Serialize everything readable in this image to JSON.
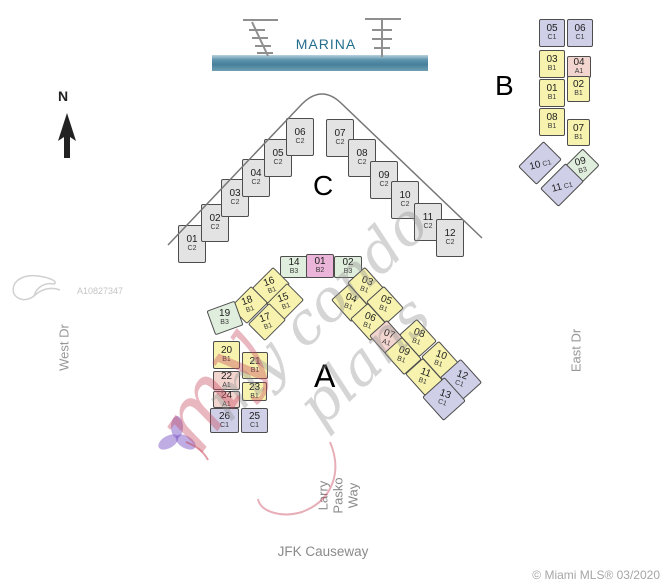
{
  "labels": {
    "marina": "MARINA",
    "north": "N"
  },
  "streets": {
    "west": "West Dr",
    "east": "East Dr",
    "south": "JFK Causeway",
    "inner_lines": [
      "Larry",
      "Pasko",
      "Way"
    ]
  },
  "watermarks": {
    "photo_id": "A10827347",
    "script": "my condo plans",
    "script_red": "my",
    "attribution": "© Miami MLS® 03/2020"
  },
  "unit_colors": {
    "A1": "#f3d5cf",
    "B1": "#f7f3ae",
    "B2": "#eab5d8",
    "B3": "#e0eedd",
    "C1": "#cfcfe8",
    "C2": "#e3e3e3"
  },
  "buildings": [
    {
      "id": "C",
      "label": "C",
      "label_pos": {
        "x": 313,
        "y": 172,
        "size": 28
      },
      "units": [
        {
          "n": "01",
          "t": "C2",
          "x": 178,
          "y": 225,
          "w": 28,
          "h": 38,
          "r": 0,
          "lr": 0
        },
        {
          "n": "02",
          "t": "C2",
          "x": 201,
          "y": 204,
          "w": 28,
          "h": 38,
          "r": 0,
          "lr": 0
        },
        {
          "n": "03",
          "t": "C2",
          "x": 221,
          "y": 179,
          "w": 28,
          "h": 38,
          "r": 0,
          "lr": 0
        },
        {
          "n": "04",
          "t": "C2",
          "x": 242,
          "y": 159,
          "w": 28,
          "h": 38,
          "r": 0,
          "lr": 0
        },
        {
          "n": "05",
          "t": "C2",
          "x": 264,
          "y": 139,
          "w": 28,
          "h": 38,
          "r": 0,
          "lr": 0
        },
        {
          "n": "06",
          "t": "C2",
          "x": 286,
          "y": 118,
          "w": 28,
          "h": 38,
          "r": 0,
          "lr": 0
        },
        {
          "n": "07",
          "t": "C2",
          "x": 326,
          "y": 119,
          "w": 28,
          "h": 38,
          "r": 0,
          "lr": 0
        },
        {
          "n": "08",
          "t": "C2",
          "x": 348,
          "y": 139,
          "w": 28,
          "h": 38,
          "r": 0,
          "lr": 0
        },
        {
          "n": "09",
          "t": "C2",
          "x": 370,
          "y": 161,
          "w": 28,
          "h": 38,
          "r": 0,
          "lr": 0
        },
        {
          "n": "10",
          "t": "C2",
          "x": 391,
          "y": 181,
          "w": 28,
          "h": 38,
          "r": 0,
          "lr": 0
        },
        {
          "n": "11",
          "t": "C2",
          "x": 414,
          "y": 203,
          "w": 28,
          "h": 38,
          "r": 0,
          "lr": 0
        },
        {
          "n": "12",
          "t": "C2",
          "x": 436,
          "y": 219,
          "w": 28,
          "h": 38,
          "r": 0,
          "lr": 0
        }
      ]
    },
    {
      "id": "B",
      "label": "B",
      "label_pos": {
        "x": 495,
        "y": 72,
        "size": 28
      },
      "units": [
        {
          "n": "05",
          "t": "C1",
          "x": 539,
          "y": 19,
          "w": 26,
          "h": 28,
          "r": 0,
          "lr": 0
        },
        {
          "n": "06",
          "t": "C1",
          "x": 567,
          "y": 19,
          "w": 26,
          "h": 28,
          "r": 0,
          "lr": 0
        },
        {
          "n": "03",
          "t": "B1",
          "x": 539,
          "y": 50,
          "w": 26,
          "h": 28,
          "r": 0,
          "lr": 0
        },
        {
          "n": "04",
          "t": "A1",
          "x": 567,
          "y": 56,
          "w": 24,
          "h": 22,
          "r": 0,
          "lr": 0
        },
        {
          "n": "01",
          "t": "B1",
          "x": 539,
          "y": 79,
          "w": 26,
          "h": 28,
          "r": 0,
          "lr": 0
        },
        {
          "n": "02",
          "t": "B1",
          "x": 567,
          "y": 76,
          "w": 23,
          "h": 26,
          "r": 0,
          "lr": 0
        },
        {
          "n": "08",
          "t": "B1",
          "x": 539,
          "y": 108,
          "w": 26,
          "h": 28,
          "r": 0,
          "lr": 0
        },
        {
          "n": "07",
          "t": "B1",
          "x": 567,
          "y": 119,
          "w": 23,
          "h": 27,
          "r": 0,
          "lr": 0
        },
        {
          "n": "10",
          "t": "C1",
          "x": 522,
          "y": 150,
          "w": 36,
          "h": 26,
          "r": -45,
          "lr": 30,
          "inline": true
        },
        {
          "n": "09",
          "t": "B3",
          "x": 569,
          "y": 154,
          "w": 26,
          "h": 24,
          "r": -45,
          "lr": 30
        },
        {
          "n": "11",
          "t": "C1",
          "x": 544,
          "y": 172,
          "w": 36,
          "h": 26,
          "r": -45,
          "lr": 30,
          "inline": true
        }
      ]
    },
    {
      "id": "A",
      "label": "A",
      "label_pos": {
        "x": 314,
        "y": 360,
        "size": 32
      },
      "units": [
        {
          "n": "14",
          "t": "B3",
          "x": 280,
          "y": 256,
          "w": 28,
          "h": 22,
          "r": 0,
          "lr": 0
        },
        {
          "n": "01",
          "t": "B2",
          "x": 306,
          "y": 254,
          "w": 28,
          "h": 24,
          "r": 0,
          "lr": 0
        },
        {
          "n": "02",
          "t": "B3",
          "x": 334,
          "y": 256,
          "w": 28,
          "h": 22,
          "r": 0,
          "lr": 0
        },
        {
          "n": "16",
          "t": "B1",
          "x": 256,
          "y": 274,
          "w": 30,
          "h": 24,
          "r": -45,
          "lr": 25
        },
        {
          "n": "15",
          "t": "B1",
          "x": 270,
          "y": 290,
          "w": 30,
          "h": 24,
          "r": -45,
          "lr": 25
        },
        {
          "n": "18",
          "t": "B1",
          "x": 234,
          "y": 293,
          "w": 30,
          "h": 24,
          "r": -45,
          "lr": 25
        },
        {
          "n": "17",
          "t": "B1",
          "x": 252,
          "y": 310,
          "w": 30,
          "h": 24,
          "r": -45,
          "lr": 25
        },
        {
          "n": "19",
          "t": "B3",
          "x": 210,
          "y": 305,
          "w": 30,
          "h": 26,
          "r": -20,
          "lr": 20
        },
        {
          "n": "20",
          "t": "B1",
          "x": 213,
          "y": 341,
          "w": 27,
          "h": 28,
          "r": 0,
          "lr": 0
        },
        {
          "n": "21",
          "t": "B1",
          "x": 242,
          "y": 352,
          "w": 26,
          "h": 27,
          "r": 0,
          "lr": 0
        },
        {
          "n": "22",
          "t": "A1",
          "x": 213,
          "y": 371,
          "w": 27,
          "h": 19,
          "r": 0,
          "lr": 0
        },
        {
          "n": "23",
          "t": "B1",
          "x": 242,
          "y": 382,
          "w": 25,
          "h": 19,
          "r": 0,
          "lr": 0
        },
        {
          "n": "24",
          "t": "A1",
          "x": 213,
          "y": 391,
          "w": 27,
          "h": 17,
          "r": 0,
          "lr": 0
        },
        {
          "n": "26",
          "t": "C1",
          "x": 210,
          "y": 408,
          "w": 29,
          "h": 25,
          "r": 0,
          "lr": 0
        },
        {
          "n": "25",
          "t": "C1",
          "x": 241,
          "y": 408,
          "w": 27,
          "h": 25,
          "r": 0,
          "lr": 0
        },
        {
          "n": "03",
          "t": "B1",
          "x": 351,
          "y": 274,
          "w": 30,
          "h": 24,
          "r": 48,
          "lr": -28
        },
        {
          "n": "04",
          "t": "B1",
          "x": 335,
          "y": 291,
          "w": 30,
          "h": 24,
          "r": 48,
          "lr": -28
        },
        {
          "n": "05",
          "t": "B1",
          "x": 370,
          "y": 293,
          "w": 30,
          "h": 24,
          "r": 48,
          "lr": -28
        },
        {
          "n": "06",
          "t": "B1",
          "x": 354,
          "y": 310,
          "w": 30,
          "h": 24,
          "r": 48,
          "lr": -28
        },
        {
          "n": "07",
          "t": "A1",
          "x": 373,
          "y": 327,
          "w": 30,
          "h": 24,
          "r": 48,
          "lr": -28
        },
        {
          "n": "08",
          "t": "B1",
          "x": 403,
          "y": 326,
          "w": 30,
          "h": 24,
          "r": 48,
          "lr": -28
        },
        {
          "n": "09",
          "t": "B1",
          "x": 388,
          "y": 344,
          "w": 30,
          "h": 24,
          "r": 48,
          "lr": -28
        },
        {
          "n": "10",
          "t": "B1",
          "x": 425,
          "y": 348,
          "w": 30,
          "h": 24,
          "r": 48,
          "lr": -28
        },
        {
          "n": "11",
          "t": "B1",
          "x": 409,
          "y": 365,
          "w": 30,
          "h": 24,
          "r": 48,
          "lr": -28
        },
        {
          "n": "12",
          "t": "C1",
          "x": 445,
          "y": 366,
          "w": 32,
          "h": 28,
          "r": 48,
          "lr": -28
        },
        {
          "n": "13",
          "t": "C1",
          "x": 428,
          "y": 384,
          "w": 32,
          "h": 30,
          "r": 48,
          "lr": -28
        }
      ]
    }
  ]
}
